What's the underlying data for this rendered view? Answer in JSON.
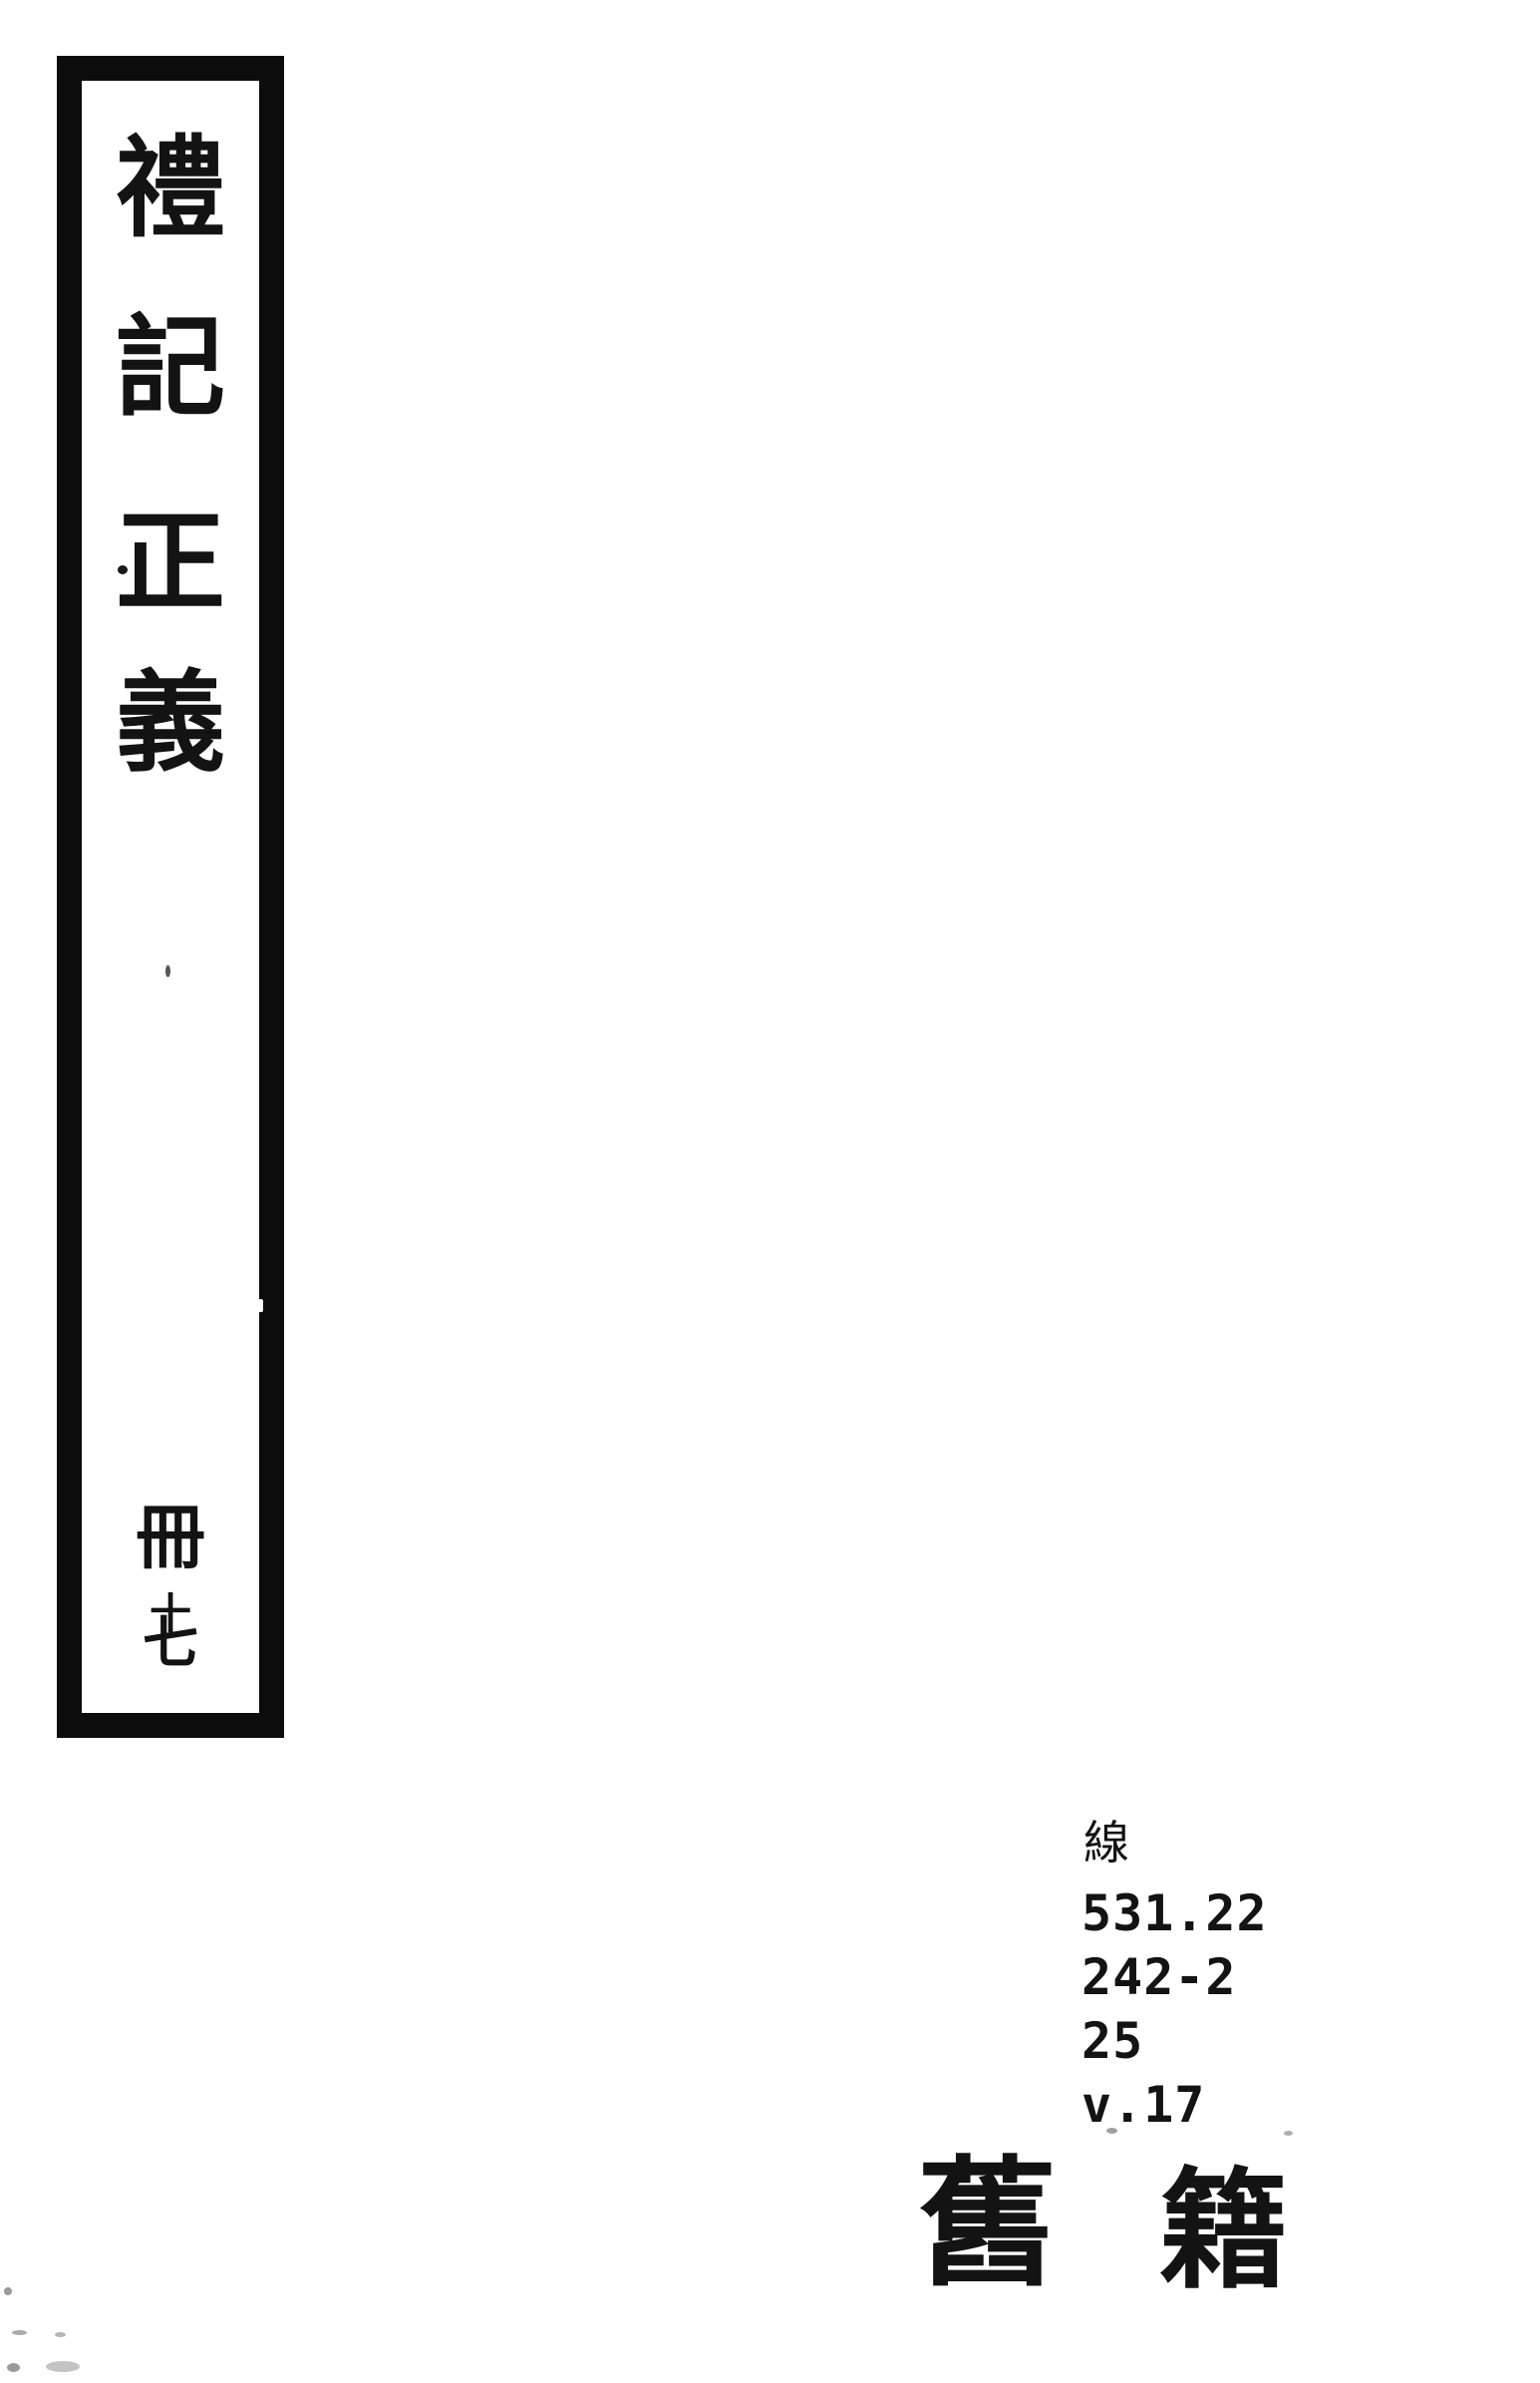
{
  "colors": {
    "ink": "#131313",
    "border": "#0c0c0c",
    "background": "#ffffff"
  },
  "spine_label": {
    "title_chars": [
      "禮",
      "記",
      "正",
      "義"
    ],
    "volume_chars": [
      "冊",
      "十",
      "七"
    ]
  },
  "call_number": {
    "category": "線",
    "lines": [
      "531.22",
      "242-2",
      "25",
      "v.17"
    ]
  },
  "collection_stamp": {
    "chars": [
      "舊",
      "籍"
    ]
  }
}
